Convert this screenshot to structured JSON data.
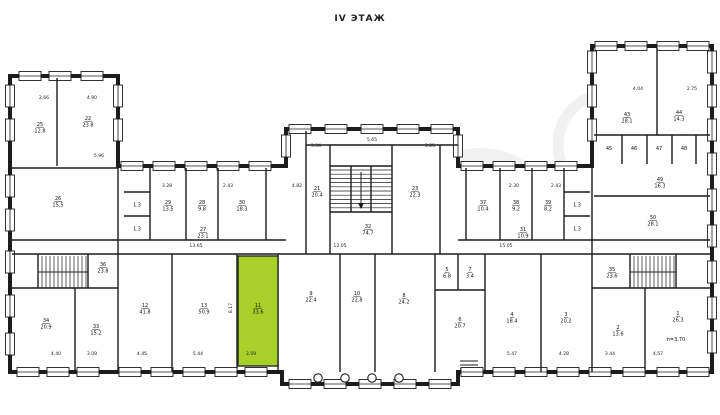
{
  "title": "IV ЭТАЖ",
  "plan": {
    "floor_label": "IV ЭТАЖ",
    "wall_color": "#1c1c1c",
    "highlight_color": "#a7d129",
    "highlighted_room": {
      "number": "11",
      "area": "33.6",
      "width_dim": "3.59",
      "height_dim": "8.17"
    },
    "ceiling_note": "h=3.70",
    "rooms": [
      {
        "n": "25",
        "a": "12.8"
      },
      {
        "n": "22",
        "a": "23.8"
      },
      {
        "n": "26",
        "a": "15.5"
      },
      {
        "n": "27",
        "a": "23.1"
      },
      {
        "n": "32",
        "a": "74.7"
      },
      {
        "n": "31",
        "a": "10.9"
      },
      {
        "n": "36",
        "a": "23.8"
      },
      {
        "n": "34",
        "a": "20.9"
      },
      {
        "n": "33",
        "a": "15.2"
      },
      {
        "n": "",
        "a": "1.3"
      },
      {
        "n": "",
        "a": "1.3"
      },
      {
        "n": "29",
        "a": "13.5"
      },
      {
        "n": "28",
        "a": "9.8"
      },
      {
        "n": "30",
        "a": "18.3"
      },
      {
        "n": "21",
        "a": "20.4"
      },
      {
        "n": "23",
        "a": "22.3"
      },
      {
        "n": "37",
        "a": "10.4"
      },
      {
        "n": "38",
        "a": "9.2"
      },
      {
        "n": "39",
        "a": "8.2"
      },
      {
        "n": "",
        "a": "1.3"
      },
      {
        "n": "",
        "a": "1.3"
      },
      {
        "n": "43",
        "a": "28.1"
      },
      {
        "n": "44",
        "a": "14.3"
      },
      {
        "n": "45",
        "a": ""
      },
      {
        "n": "46",
        "a": ""
      },
      {
        "n": "47",
        "a": ""
      },
      {
        "n": "48",
        "a": ""
      },
      {
        "n": "49",
        "a": "16.3"
      },
      {
        "n": "50",
        "a": "28.1"
      },
      {
        "n": "35",
        "a": "23.6"
      },
      {
        "n": "2",
        "a": "13.6"
      },
      {
        "n": "1",
        "a": "26.3"
      },
      {
        "n": "12",
        "a": "41.8"
      },
      {
        "n": "13",
        "a": "50.9"
      },
      {
        "n": "11",
        "a": "33.6"
      },
      {
        "n": "9",
        "a": "22.4"
      },
      {
        "n": "10",
        "a": "22.8"
      },
      {
        "n": "8",
        "a": "24.2"
      },
      {
        "n": "5",
        "a": "6.8"
      },
      {
        "n": "7",
        "a": "3.4"
      },
      {
        "n": "6",
        "a": "20.7"
      },
      {
        "n": "4",
        "a": "18.4"
      },
      {
        "n": "3",
        "a": "20.2"
      }
    ],
    "dimensions": [
      "2.66",
      "4.90",
      "5.96",
      "3.28",
      "2.43",
      "4.82",
      "3.34",
      "5.65",
      "3.25",
      "2.30",
      "2.43",
      "4.04",
      "2.75",
      "13.65",
      "12.05",
      "15.05",
      "4.40",
      "3.09",
      "4.45",
      "5.44",
      "3.59",
      "5.47",
      "4.28",
      "3.44",
      "4.57",
      "8.17"
    ]
  }
}
